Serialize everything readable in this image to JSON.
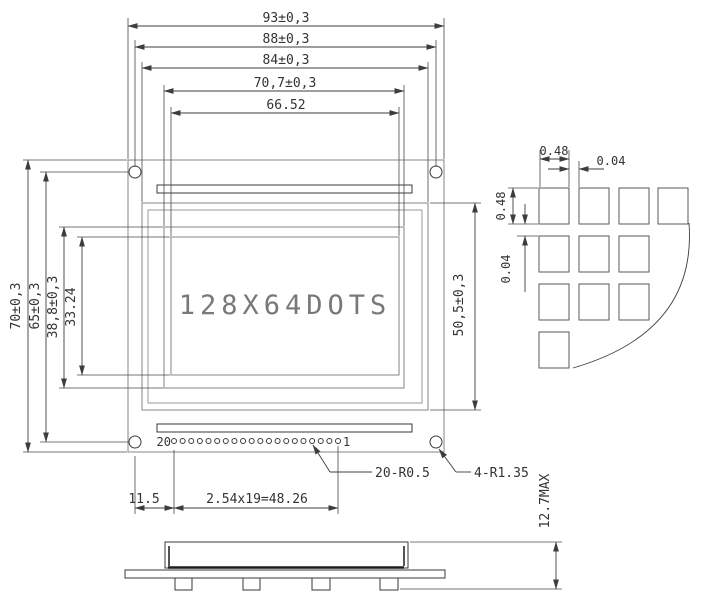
{
  "front_view": {
    "display_text": "128X64DOTS",
    "pin_first_label": "20",
    "pin_last_label": "1",
    "pin_count": 20
  },
  "dimensions": {
    "top": [
      "93±0,3",
      "88±0,3",
      "84±0,3",
      "70,7±0,3",
      "66.52"
    ],
    "left": [
      "70±0,3",
      "65±0,3",
      "38,8±0,3",
      "33.24"
    ],
    "right": "50,5±0,3",
    "bottom": [
      "11.5",
      "2.54x19=48.26"
    ],
    "side_height": "12.7MAX"
  },
  "leaders": {
    "pins": "20-R0.5",
    "holes": "4-R1.35"
  },
  "detail_view": {
    "dot_width": "0.48",
    "dot_gap_h": "0.04",
    "dot_height": "0.48",
    "dot_gap_v": "0.04",
    "rows": [
      4,
      3,
      3,
      1
    ]
  },
  "colors": {
    "background": "#ffffff",
    "line_gray": "#858585",
    "line_dark": "#3a3a3a",
    "dimension": "#3d3d3d",
    "display_text": "#787878"
  }
}
